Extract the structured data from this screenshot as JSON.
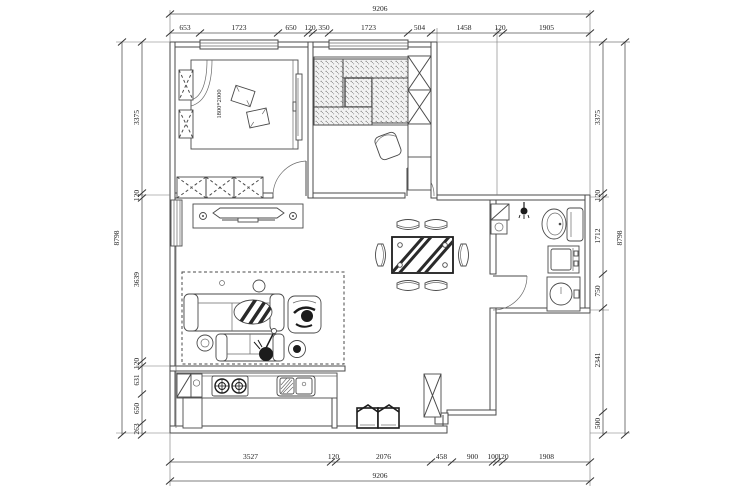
{
  "plan": {
    "colors": {
      "line": "#4a4a4a",
      "dark": "#1c1c1c",
      "stipple": "#8a8a8a",
      "background": "#ffffff"
    },
    "dims": {
      "top_overall": "9206",
      "top": [
        "653",
        "1723",
        "650",
        "120",
        "350",
        "1723",
        "504",
        "1458",
        "120",
        "1905"
      ],
      "bottom": [
        "3527",
        "120",
        "2076",
        "458",
        "900",
        "100",
        "120",
        "1908"
      ],
      "bottom_overall": "9206",
      "left_overall": "8798",
      "left": [
        "3375",
        "120",
        "3639",
        "120",
        "631",
        "650",
        "263"
      ],
      "right": [
        "3375",
        "120",
        "1712",
        "750",
        "2341",
        "500"
      ],
      "right_overall": "8798"
    },
    "labels": {
      "bed_size": "1800*2000"
    },
    "symbols": [
      "double-bed",
      "pillow",
      "nightstand",
      "wardrobe",
      "bedroom-tv",
      "tatami-bed",
      "storage-column",
      "desk-chair",
      "tv-cabinet",
      "tv",
      "radiator",
      "rug",
      "sofa",
      "loveseat",
      "armchair",
      "person",
      "coffee-table",
      "side-table",
      "floor-lamp",
      "stool",
      "dining-table",
      "dining-chair",
      "kitchen-counter",
      "fridge-cabinet",
      "gas-stove",
      "kitchen-sink",
      "shoe-cabinet",
      "entry-cabinet",
      "corner-shelf",
      "floor-drain",
      "shower-head",
      "toilet",
      "washing-machine",
      "washbasin",
      "door-swing",
      "window"
    ]
  }
}
